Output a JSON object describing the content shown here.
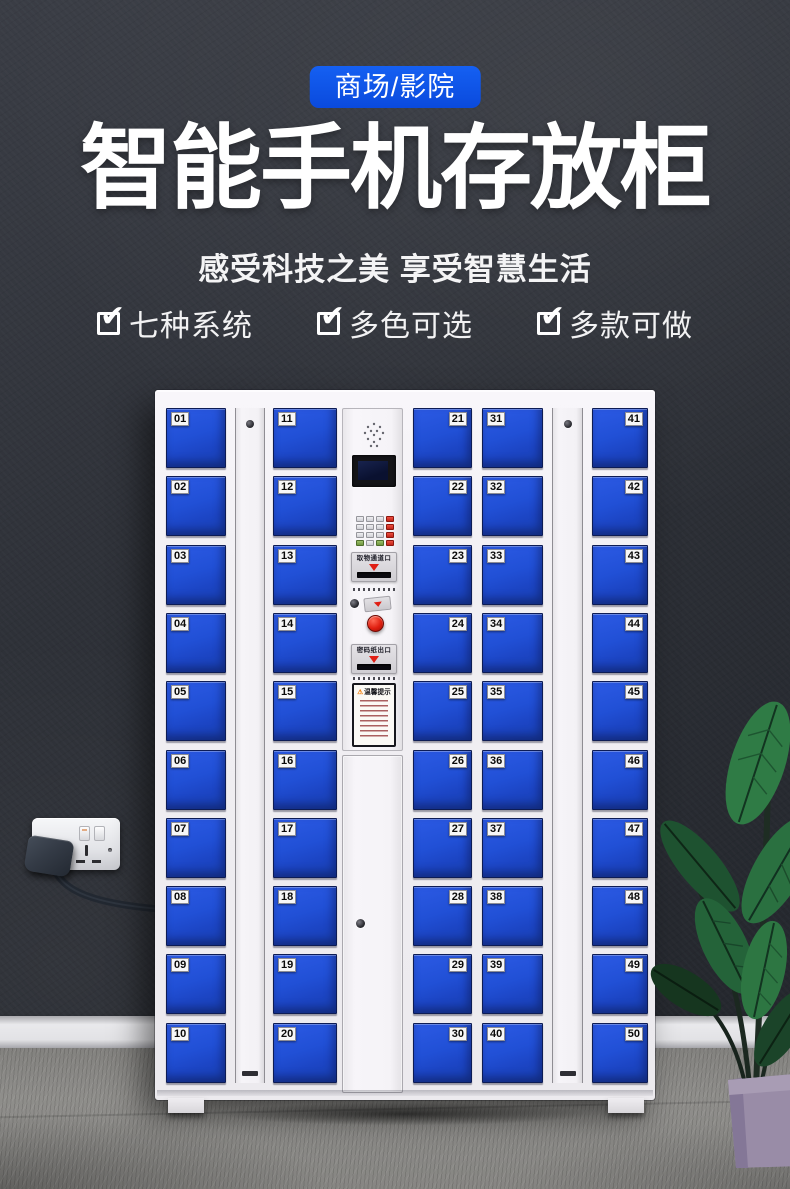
{
  "icons": {
    "feature_check": "✔",
    "warning": "⚠"
  },
  "colors": {
    "badge_blue": "#0c53e8",
    "door_blue": "#1f4bd0",
    "wall_dark": "#2d3037"
  },
  "header": {
    "badge": "商场/影院",
    "title": "智能手机存放柜",
    "subtitle": "感受科技之美 享受智慧生活",
    "features": [
      {
        "label": "七种系统"
      },
      {
        "label": "多色可选"
      },
      {
        "label": "多款可做"
      }
    ]
  },
  "cabinet": {
    "panel": {
      "slot_top_label": "取物通道口",
      "slot_bottom_label": "密码纸出口",
      "warning_title": "温馨提示"
    },
    "columns": [
      {
        "kind": "doors",
        "tag_side": "left",
        "numbers": [
          "01",
          "02",
          "03",
          "04",
          "05",
          "06",
          "07",
          "08",
          "09",
          "10"
        ]
      },
      {
        "kind": "lock_strip"
      },
      {
        "kind": "doors",
        "tag_side": "left",
        "numbers": [
          "11",
          "12",
          "13",
          "14",
          "15",
          "16",
          "17",
          "18",
          "19",
          "20"
        ]
      },
      {
        "kind": "panel"
      },
      {
        "kind": "doors",
        "tag_side": "right",
        "numbers": [
          "21",
          "22",
          "23",
          "24",
          "25",
          "26",
          "27",
          "28",
          "29",
          "30"
        ]
      },
      {
        "kind": "doors",
        "tag_side": "left",
        "numbers": [
          "31",
          "32",
          "33",
          "34",
          "35",
          "36",
          "37",
          "38",
          "39",
          "40"
        ]
      },
      {
        "kind": "lock_strip"
      },
      {
        "kind": "doors",
        "tag_side": "right",
        "numbers": [
          "41",
          "42",
          "43",
          "44",
          "45",
          "46",
          "47",
          "48",
          "49",
          "50"
        ]
      }
    ]
  }
}
